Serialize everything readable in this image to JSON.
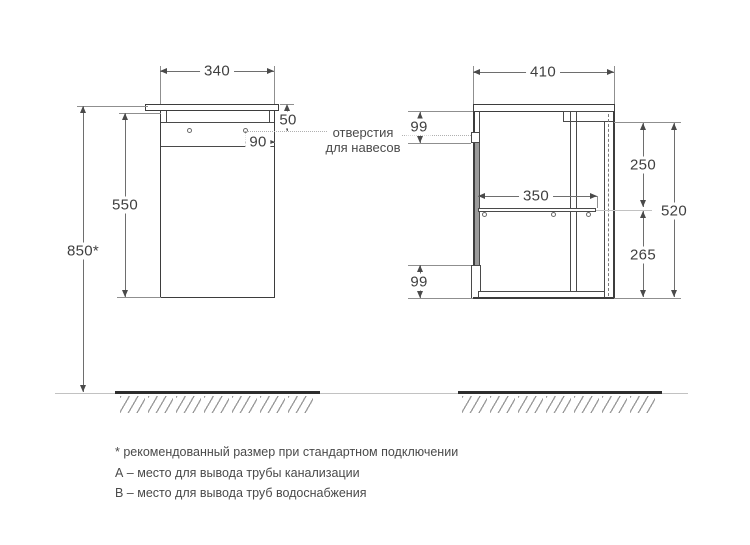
{
  "drawing": {
    "front_view": {
      "width": "340",
      "top_to_hole": "50",
      "hole_to_edge": "90",
      "cabinet_height": "550",
      "total_height": "850*"
    },
    "side_view": {
      "depth": "410",
      "hanger_offset_top": "99",
      "top_to_shelf": "250",
      "shelf_depth": "350",
      "side_height": "520",
      "shelf_to_bottom": "265",
      "bottom_offset": "99"
    },
    "annotation": {
      "line1": "отверстия",
      "line2": "для навесов"
    }
  },
  "notes": {
    "asterisk": "* рекомендованный размер при стандартном подключении",
    "a": "А – место для вывода трубы канализации",
    "b": "В – место для вывода труб водоснабжения"
  }
}
